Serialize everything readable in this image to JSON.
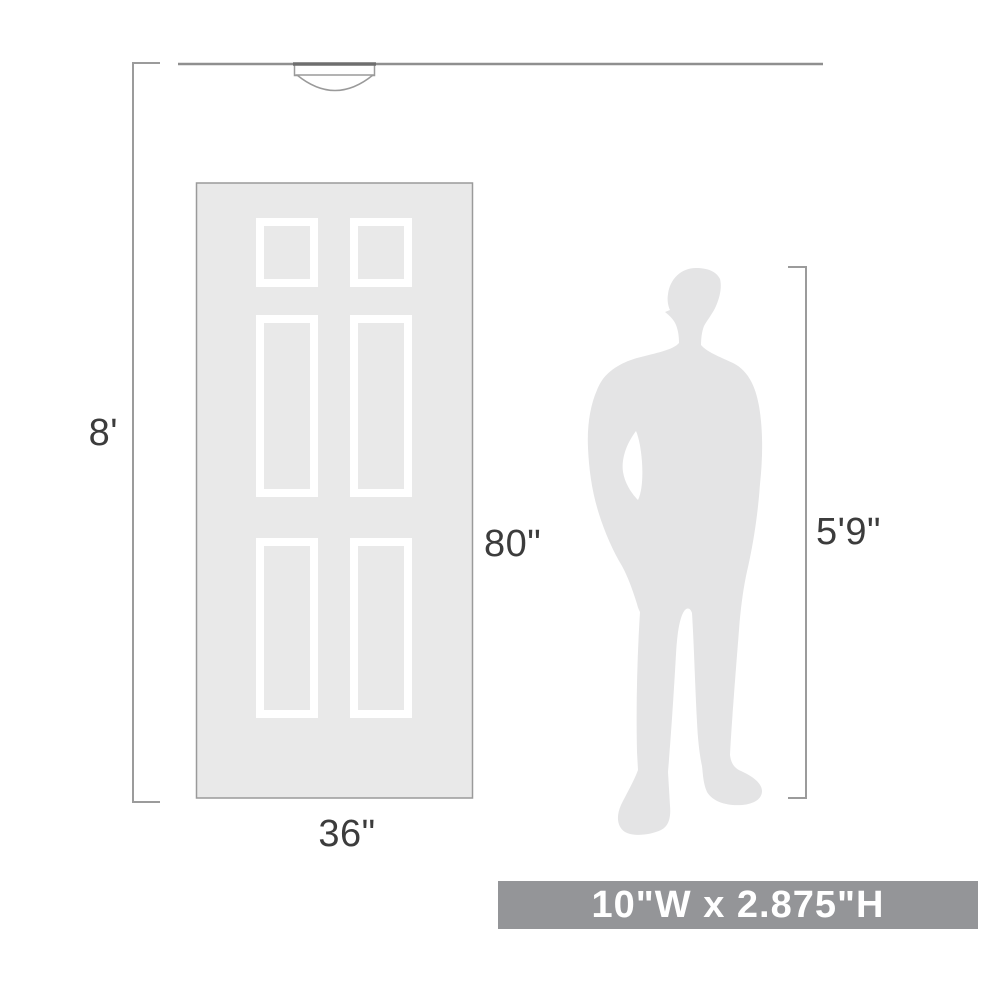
{
  "diagram": {
    "type": "product-size-comparison",
    "labels": {
      "ceiling_height": "8'",
      "door_height": "80\"",
      "door_width": "36\"",
      "person_height": "5'9\""
    },
    "banner": {
      "fixture_dimensions": "10\"W x 2.875\"H",
      "bg_color": "#949598",
      "text_color": "#ffffff"
    },
    "icons": {
      "fixture": "flush-mount-ceiling-light-icon",
      "door": "six-panel-door-icon",
      "person": "standing-man-silhouette-icon"
    },
    "colors": {
      "dimension_line": "#9b9b9b",
      "ceiling_line": "#8f8f8f",
      "label_text": "#3c3c3c",
      "door_fill": "#e9e9e9",
      "door_stroke": "#9a9a9a",
      "panel_stroke": "#ffffff",
      "person_fill": "#e4e4e5",
      "fixture_fill": "#ffffff"
    }
  }
}
